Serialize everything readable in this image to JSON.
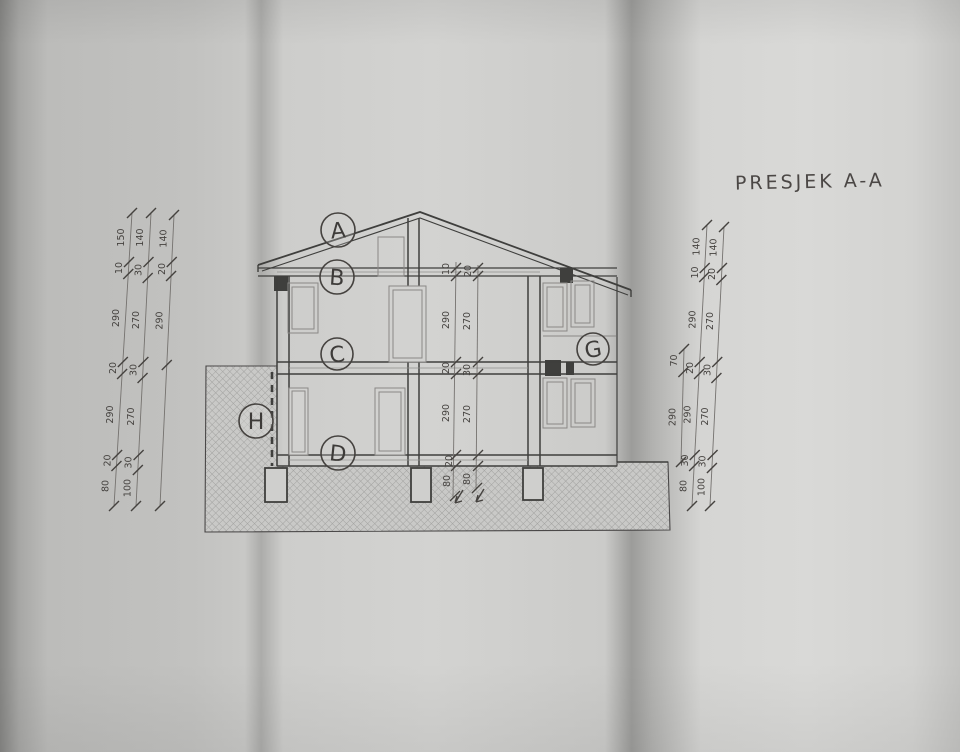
{
  "page": {
    "title": "PRESJEK A-A"
  },
  "section_labels": [
    {
      "id": "A"
    },
    {
      "id": "B"
    },
    {
      "id": "C"
    },
    {
      "id": "D"
    },
    {
      "id": "G"
    },
    {
      "id": "H"
    }
  ],
  "dimensions": {
    "left_chains": [
      {
        "segments": [
          "150",
          "10",
          "290",
          "20",
          "290",
          "20",
          "80"
        ]
      },
      {
        "segments": [
          "140",
          "30",
          "270",
          "30",
          "270",
          "30",
          "100"
        ]
      },
      {
        "segments": [
          "140",
          "20",
          "290",
          ""
        ]
      }
    ],
    "right_chains": [
      {
        "segments": [
          "70",
          "290"
        ]
      },
      {
        "segments": [
          "140",
          "10",
          "290",
          "20",
          "290",
          "30",
          "80"
        ]
      },
      {
        "segments": [
          "140",
          "20",
          "270",
          "30",
          "270",
          "30",
          "100"
        ]
      }
    ],
    "center_column": [
      "10",
      "20",
      "290",
      "270",
      "20",
      "30",
      "290",
      "270",
      "20",
      "80",
      "80"
    ]
  },
  "colors": {
    "paper": "#d2d2d0",
    "ink": "#3f3f3d",
    "light_ink": "#8f8f8d",
    "hatch": "#9d9d9b"
  }
}
